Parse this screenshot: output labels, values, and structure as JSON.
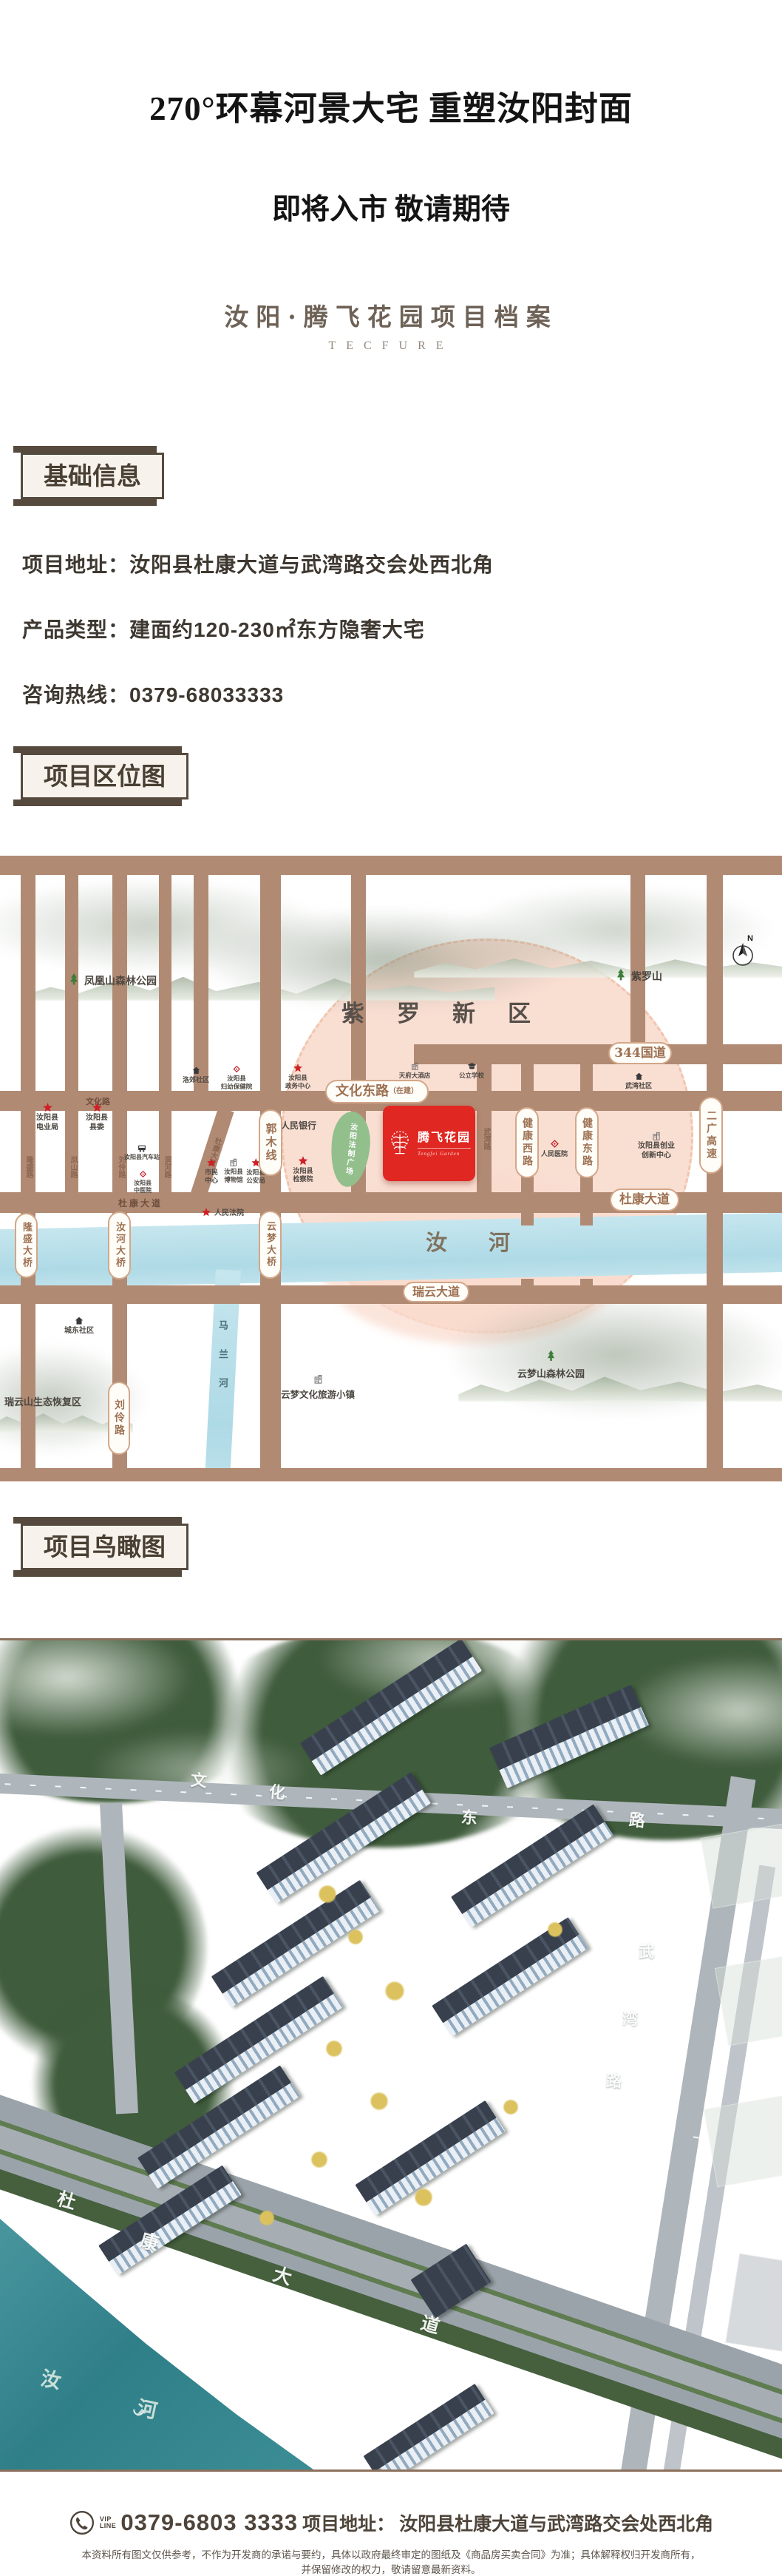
{
  "header": {
    "title": "270°环幕河景大宅 重塑汝阳封面",
    "subtitle": "即将入市 敬请期待",
    "archive_title": "汝阳·腾飞花园项目档案",
    "archive_en": "TECFURE"
  },
  "basic_info": {
    "heading": "基础信息",
    "rows": [
      {
        "label": "项目地址：",
        "value": "汝阳县杜康大道与武湾路交会处西北角"
      },
      {
        "label": "产品类型：",
        "value": "建面约120-230㎡东方隐奢大宅"
      },
      {
        "label": "咨询热线：",
        "value": "0379-68033333"
      }
    ]
  },
  "location_section": {
    "heading": "项目区位图"
  },
  "aerial_section": {
    "heading": "项目鸟瞰图"
  },
  "map": {
    "district": "紫罗新区",
    "north": "N",
    "parks": {
      "fenghuang": "凤凰山森林公园",
      "ziluo": "紫罗山",
      "yunmengshan": "云梦山森林公园"
    },
    "areas": {
      "shengtai": "瑞云山生态恢复区",
      "xiaozhen": "云梦文化旅游小镇"
    },
    "rivers": {
      "ruhe": "汝河",
      "malan": "马兰河"
    },
    "pills": {
      "wenhuadong": "文化东路",
      "zaijian": "（在建）",
      "g344": "344国道",
      "dukang": "杜康大道",
      "ruiyun": "瑞云大道",
      "guomu": "郭木线",
      "jk_west": "健康西路",
      "jk_east": "健康东路",
      "erguang": "二广高速",
      "liuling": "刘伶路",
      "longsheng_br": "隆盛大桥",
      "ruhe_br": "汝河大桥",
      "yunmeng_br": "云梦大桥"
    },
    "streets": {
      "wenhua": "文化路",
      "dukang_left": "杜康大道",
      "longsheng": "隆盛路",
      "fengshan": "凤山路",
      "liuling_n": "刘伶路",
      "donghe": "洞河路",
      "dukang_diag": "杜康大道",
      "wuwan": "武湾路"
    },
    "pois": {
      "dianyeju": "汝阳县\n电业局",
      "xianwei": "汝阳县\n县委",
      "luojiao": "洛郊社区",
      "fuyou": "汝阳县\n妇幼保健院",
      "zhengwu": "汝阳县\n政务中心",
      "tianfu": "天府大酒店",
      "gongli": "公立学校",
      "wuwan_c": "武湾社区",
      "yinhang": "人民银行",
      "shimin": "市民\n中心",
      "bowuguan": "汝阳县\n博物馆",
      "gongan": "汝阳县\n公安局",
      "jianchayuan": "汝阳县\n检察院",
      "qichezhan": "汝阳县汽车站",
      "zhongyiyuan": "汝阳县\n中医院",
      "fayuan": "人民法院",
      "renminyiyuan": "人民医院",
      "chuangye": "汝阳县创业\n创新中心",
      "chengdong": "城东社区"
    },
    "plaza": "汝阳法制广场",
    "project": {
      "name": "腾飞花园",
      "en": "Tengfei Garden"
    }
  },
  "aerial_labels": {
    "wenhuadong": [
      "文",
      "化",
      "东",
      "路"
    ],
    "wuwan": [
      "武",
      "湾",
      "路"
    ],
    "dukang": [
      "杜",
      "康",
      "大",
      "道"
    ],
    "ruhe": [
      "汝",
      "河"
    ]
  },
  "footer": {
    "vip": "VIP\nLINE",
    "phone": "0379-6803 3333",
    "addr_label": "项目地址：",
    "addr": "汝阳县杜康大道与武湾路交会处西北角",
    "disclaimer1": "本资料所有图文仅供参考，不作为开发商的承诺与要约，具体以政府最终审定的图纸及《商品房买卖合同》为准；具体解释权归开发商所有，",
    "disclaimer2": "并保留修改的权力，敬请留意最新资料。"
  }
}
